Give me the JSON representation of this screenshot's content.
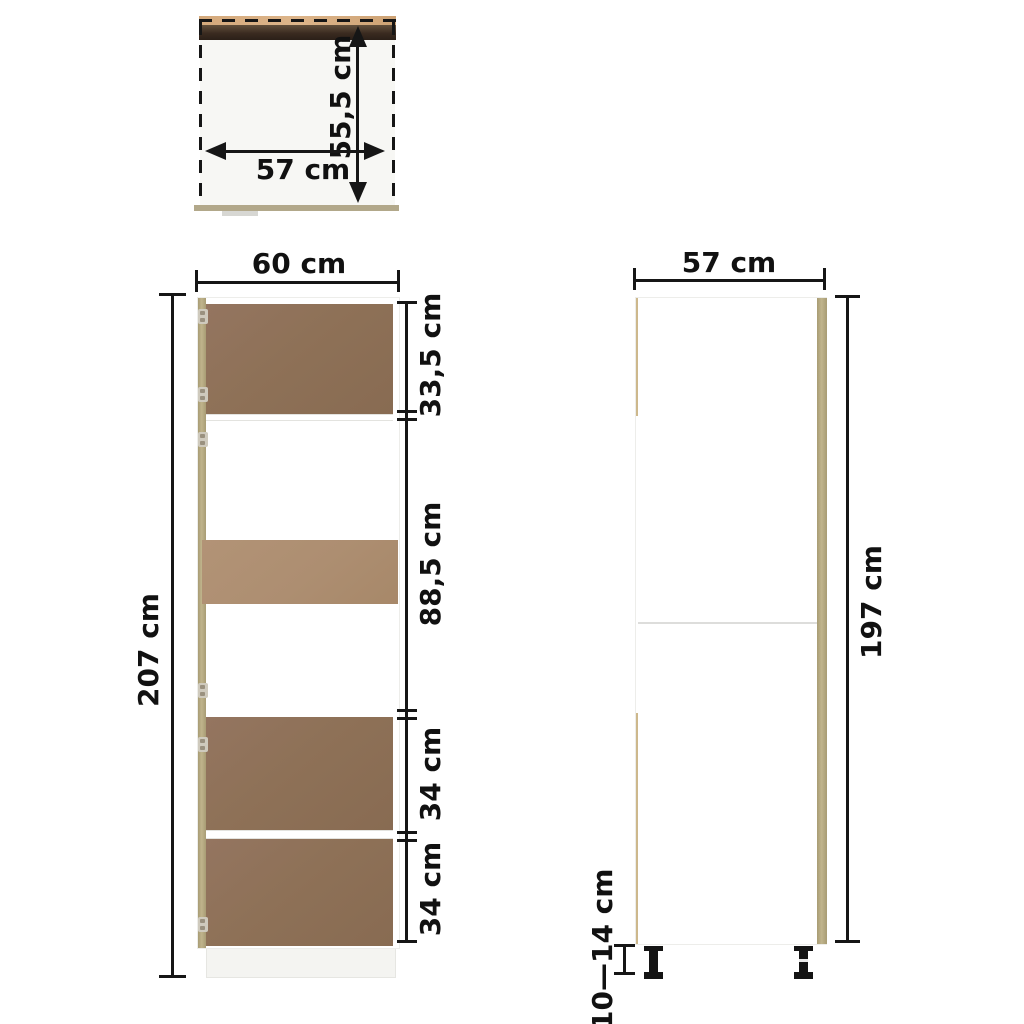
{
  "top_view": {
    "depth_label": "55,5 cm",
    "width_label": "57 cm"
  },
  "front_view": {
    "width_label": "60 cm",
    "height_label": "207 cm",
    "sections": [
      {
        "label": "33,5 cm"
      },
      {
        "label": "88,5 cm"
      },
      {
        "label": "34 cm"
      },
      {
        "label": "34 cm"
      }
    ]
  },
  "side_view": {
    "width_label": "57 cm",
    "height_label": "197 cm",
    "legs_height_label": "10—14 cm"
  },
  "colors": {
    "dimension_line": "#161616",
    "door_oak": "#8e7157",
    "niche_oak": "#ad8e71",
    "edge_tan": "#b7ac86",
    "top_edge_tan": "#d4a97c",
    "front_dark_brown": "#3a2b20",
    "back_rail_tan": "#b2a88a",
    "leg_black": "#141414"
  }
}
